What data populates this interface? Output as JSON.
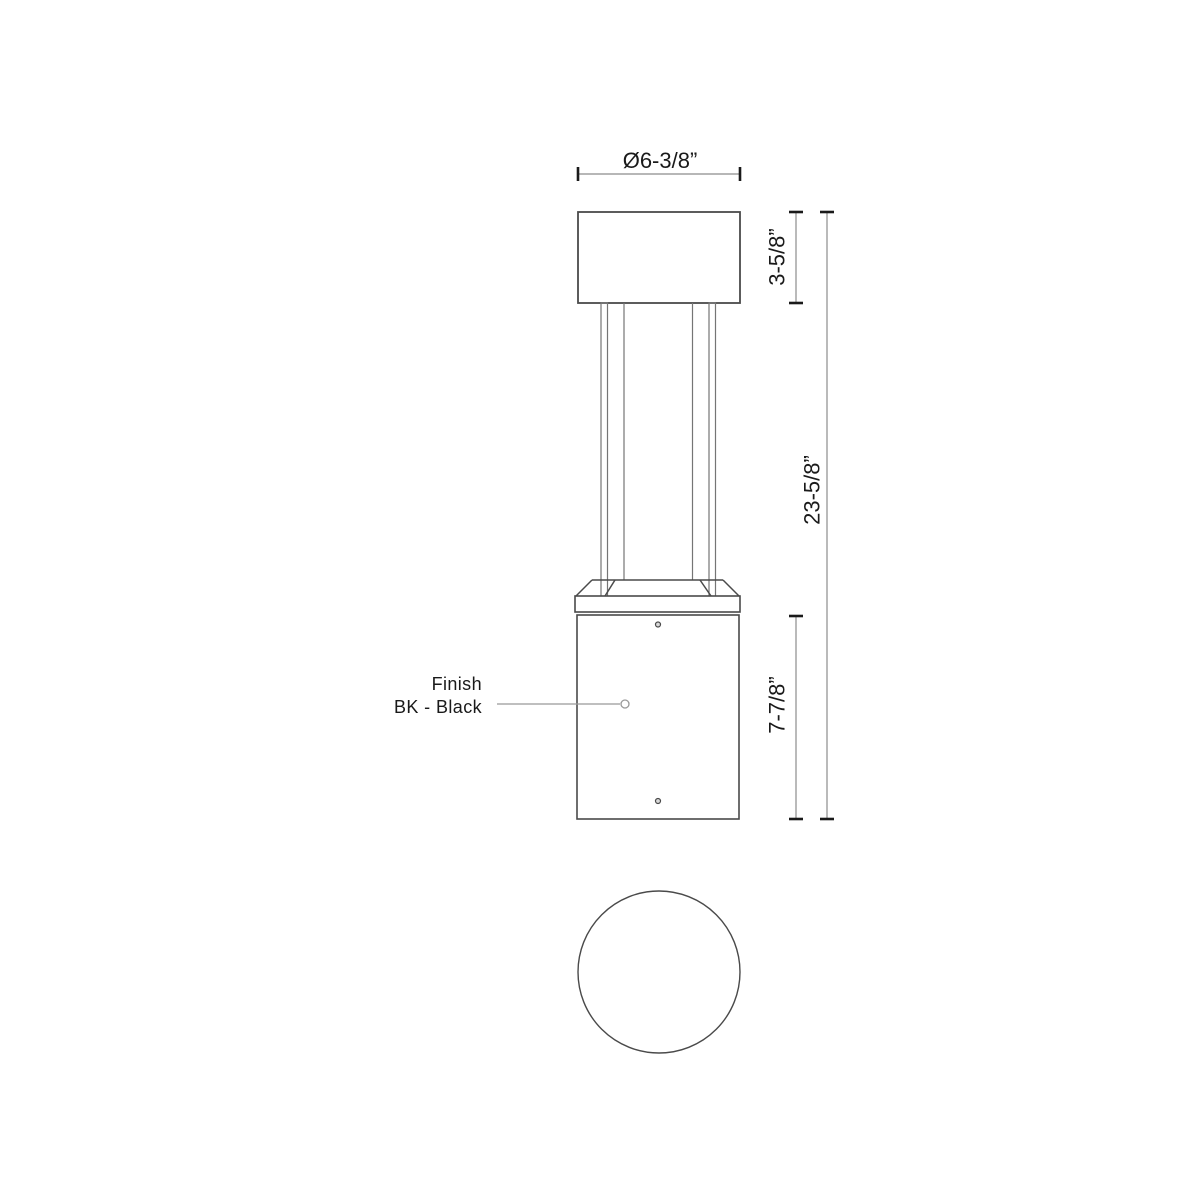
{
  "drawing": {
    "type": "technical-dimension-drawing",
    "views": {
      "front_view": "bollard-front-elevation",
      "top_view": "bollard-top-plan-circle"
    }
  },
  "dimensions": {
    "diameter": "Ø6-3/8”",
    "cap_height": "3-5/8”",
    "overall_height": "23-5/8”",
    "base_height": "7-7/8”"
  },
  "callout": {
    "line1": "Finish",
    "line2": "BK - Black"
  },
  "colors": {
    "background": "#ffffff",
    "outline": "#4a4a4a",
    "inner_line": "#757575",
    "dimension_line": "#8c8c8c",
    "tick": "#1a1a1a",
    "leader_line": "#999999",
    "text": "#1a1a1a",
    "screw_fill": "#d9d9d9"
  }
}
